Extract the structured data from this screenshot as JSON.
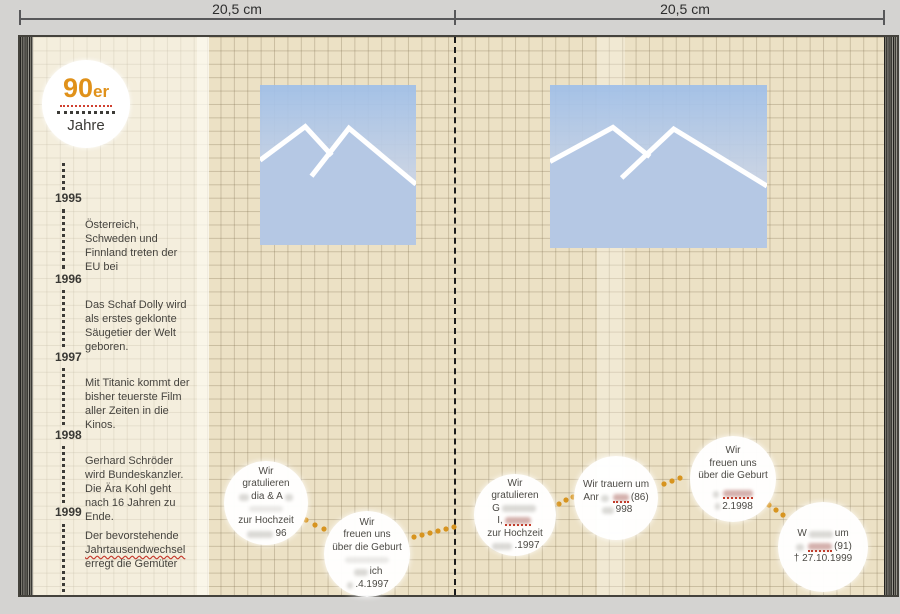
{
  "ruler": {
    "left_label": "20,5 cm",
    "right_label": "20,5 cm"
  },
  "badge": {
    "decade": "90",
    "decade_suffix": "er",
    "subtitle": "Jahre"
  },
  "timeline": {
    "entries": [
      {
        "year": "1995",
        "text": "Österreich, Schweden und Finnland treten der EU bei"
      },
      {
        "year": "1996",
        "text": "Das Schaf Dolly wird als erstes geklonte Säugetier der Welt geboren."
      },
      {
        "year": "1997",
        "text": "Mit Titanic kommt der bisher teuerste Film aller Zeiten in die Kinos."
      },
      {
        "year": "1998",
        "text": "Gerhard Schröder wird Bundeskanzler. Die Ära Kohl geht nach 16 Jahren zu Ende."
      },
      {
        "year": "1999",
        "text_before": "Der bevorstehende ",
        "text_marked": "Jahrtausendwechsel",
        "text_after": " erregt die Gemüter"
      }
    ]
  },
  "bubbles": [
    {
      "lines": [
        "Wir",
        "gratulieren",
        "dia & A",
        "zur Hochzeit",
        "96"
      ]
    },
    {
      "lines": [
        "Wir",
        "freuen uns",
        "über die Geburt",
        "ich",
        ".4.1997"
      ]
    },
    {
      "lines": [
        "Wir",
        "gratulieren",
        "G",
        "I,",
        "zur Hochzeit",
        ".1997"
      ]
    },
    {
      "lines": [
        "Wir trauern um",
        "Anr",
        "(86)",
        "998"
      ]
    },
    {
      "lines": [
        "Wir",
        "freuen uns",
        "über die Geburt",
        "2.1998"
      ]
    },
    {
      "lines": [
        "W",
        "um",
        "(91)",
        "† 27.10.1999"
      ]
    }
  ],
  "icons": {
    "photo_placeholder": "mountains-icon"
  },
  "colors": {
    "accent_orange": "#dd941e",
    "connector_orange": "#d7941f",
    "marker_red": "#c53a28",
    "paper_beige": "#ece1c5",
    "photo_blue": "#a9c4e8"
  }
}
